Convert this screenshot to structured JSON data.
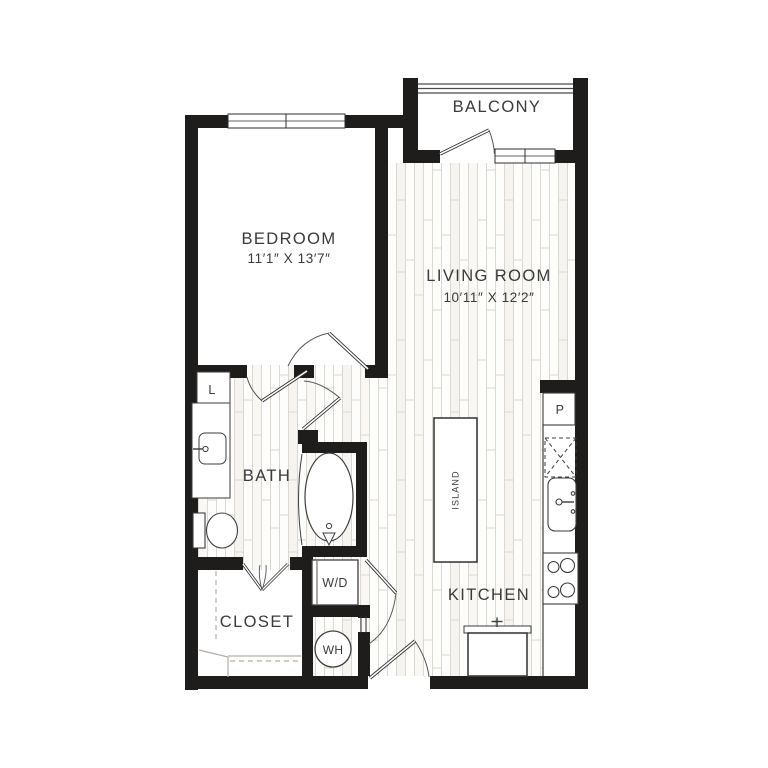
{
  "plan": {
    "type": "apartment-floor-plan",
    "rooms": {
      "balcony": {
        "label": "BALCONY"
      },
      "bedroom": {
        "label": "BEDROOM",
        "dimensions": "11′1″ X 13′7″"
      },
      "living_room": {
        "label": "LIVING ROOM",
        "dimensions": "10′11″ X 12′2″"
      },
      "bath": {
        "label": "BATH"
      },
      "closet": {
        "label": "CLOSET"
      },
      "kitchen": {
        "label": "KITCHEN"
      }
    },
    "features": {
      "island": {
        "label": "ISLAND"
      },
      "washer_dryer": {
        "label": "W/D"
      },
      "water_heater": {
        "label": "WH"
      },
      "linen_closet": {
        "label": "L"
      },
      "pantry": {
        "label": "P"
      }
    }
  },
  "colors": {
    "wall": "#1e1d1b",
    "text": "#3a3a3a",
    "fixture": "#3d3d3d",
    "shelf": "#b3afa8",
    "floor_line": "#dbd7d1",
    "floor_tint": "#f5f3ef",
    "background": "#ffffff"
  }
}
